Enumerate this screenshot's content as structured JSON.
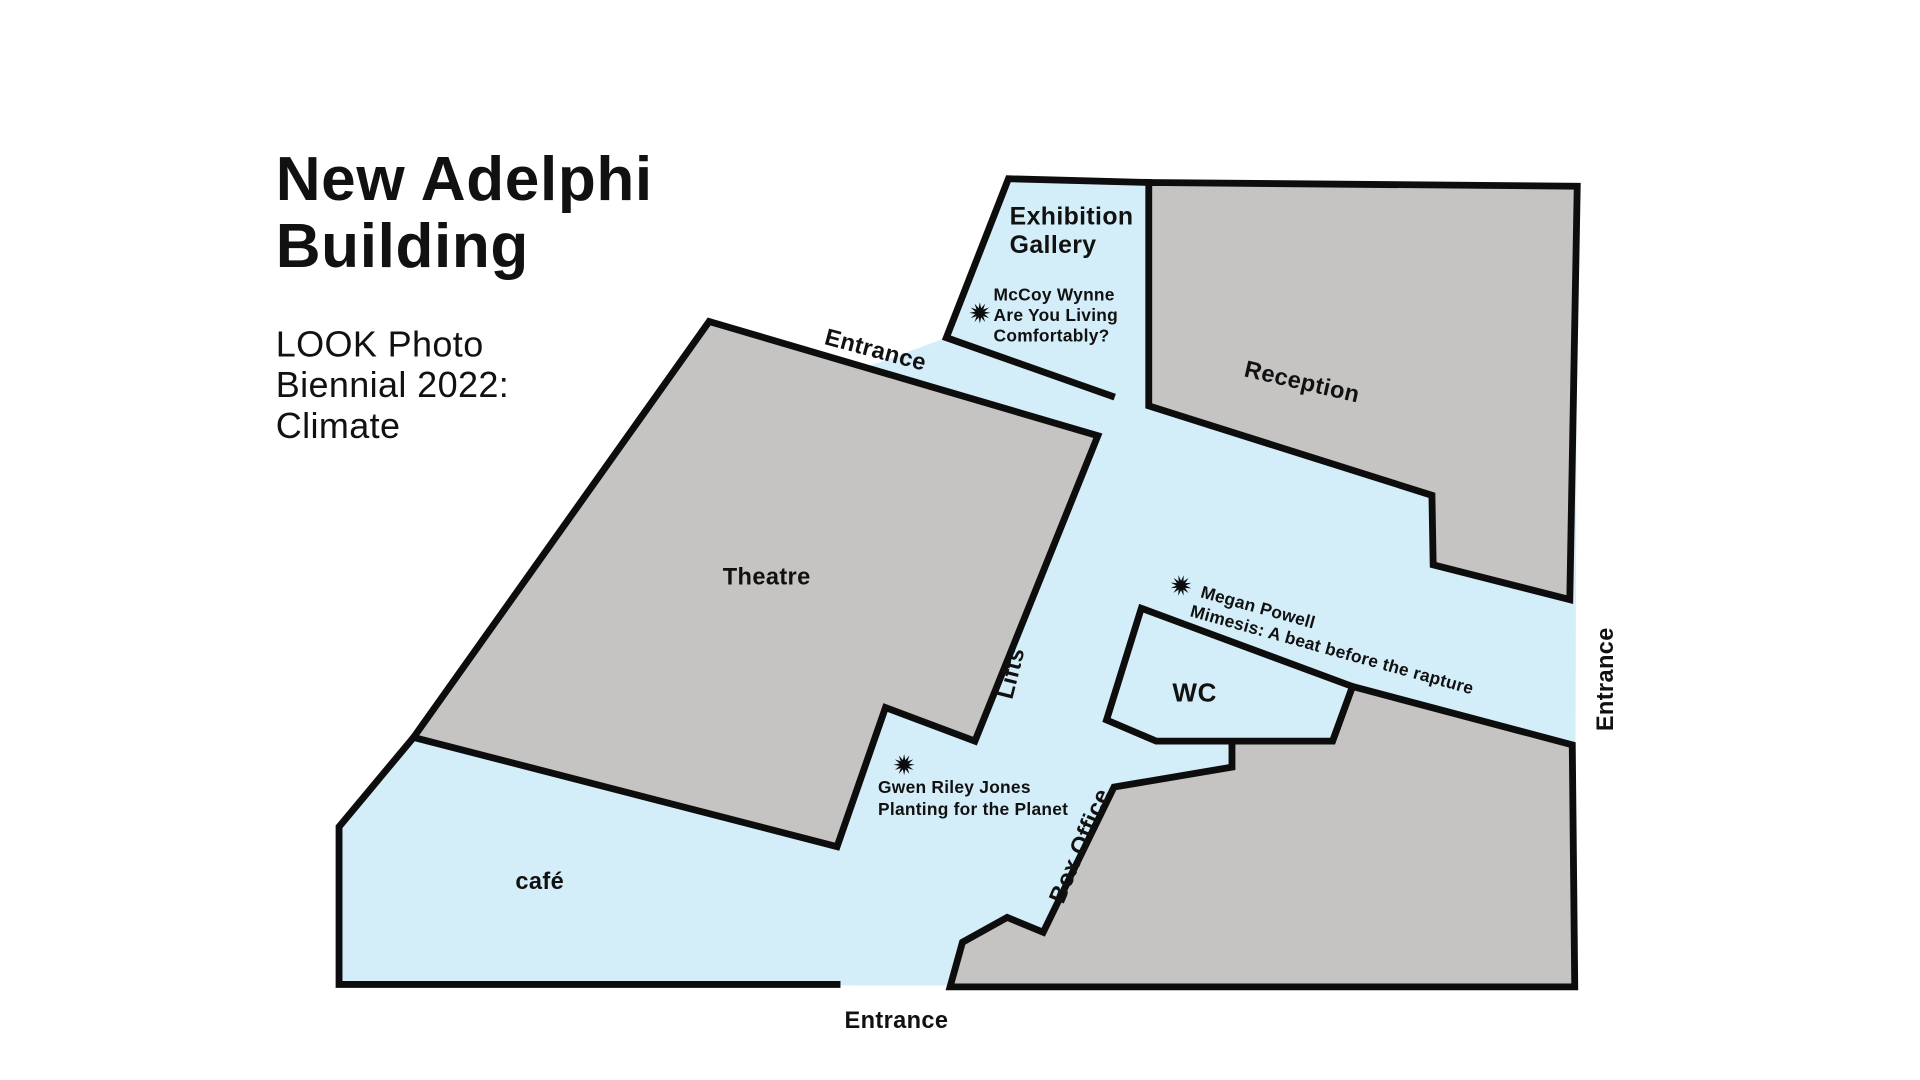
{
  "title": {
    "line1": "New Adelphi",
    "line2": "Building"
  },
  "subtitle": {
    "line1": "LOOK Photo",
    "line2": "Biennial 2022:",
    "line3": "Climate"
  },
  "colors": {
    "floor": "#d4eef9",
    "room": "#c5c4c3",
    "wall": "#0d0d0d",
    "text": "#111111"
  },
  "map": {
    "rooms": {
      "exhibition_gallery": {
        "label_line1": "Exhibition",
        "label_line2": "Gallery"
      },
      "reception": {
        "label": "Reception"
      },
      "theatre": {
        "label": "Theatre"
      },
      "wc": {
        "label": "WC"
      },
      "cafe": {
        "label": "café"
      },
      "box_office": {
        "label": "Box Office"
      },
      "lifts": {
        "label": "Lifts"
      }
    },
    "entrances": {
      "top": "Entrance",
      "bottom": "Entrance",
      "right": "Entrance"
    },
    "exhibits": [
      {
        "artist": "McCoy Wynne",
        "work_line1": "Are You Living",
        "work_line2": "Comfortably?",
        "marker": "star"
      },
      {
        "artist": "Megan Powell",
        "work": "Mimesis: A beat before the rapture",
        "marker": "star"
      },
      {
        "artist": "Gwen Riley Jones",
        "work": "Planting for the Planet",
        "marker": "star"
      }
    ]
  }
}
